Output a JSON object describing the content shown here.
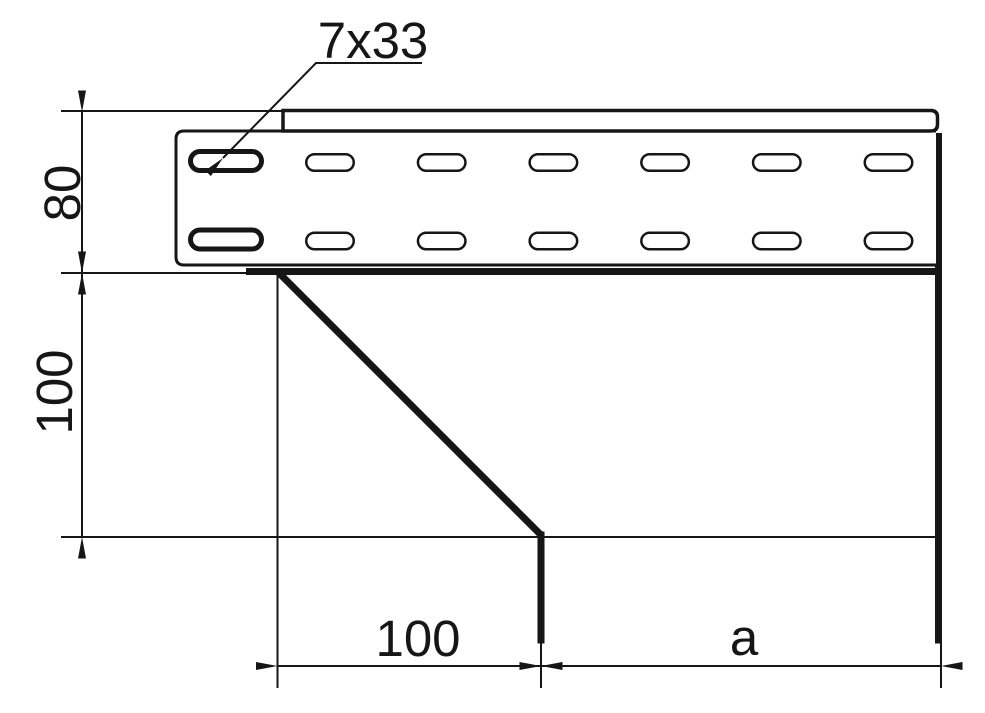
{
  "colors": {
    "ink": "#161616",
    "paper": "#ffffff"
  },
  "callout": {
    "label": "7x33"
  },
  "dimensions": {
    "side_height": {
      "label": "80"
    },
    "drop_height": {
      "label": "100"
    },
    "offset_width": {
      "label": "100"
    },
    "remaining_width": {
      "label": "a"
    }
  },
  "tray": {
    "slot_rows": 2,
    "slot_columns": 7,
    "slot_grid": {
      "bold": {
        "x": 188,
        "width": 76,
        "height": 24,
        "rows_y": [
          149,
          227.5
        ],
        "stroke": 5
      },
      "thin": {
        "start_x": 305,
        "pitch": 111.7,
        "count": 6,
        "width": 50,
        "height": 19,
        "rows_y": [
          153,
          231.5
        ],
        "stroke": 2.5
      }
    }
  }
}
